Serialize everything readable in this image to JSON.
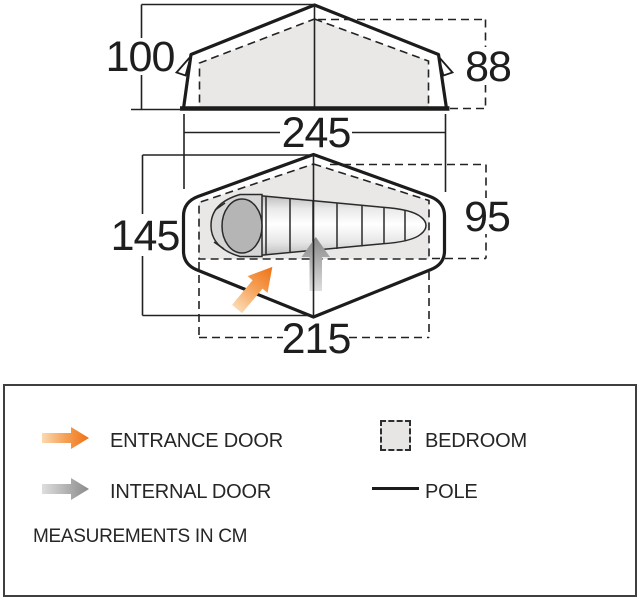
{
  "side_view": {
    "peak_height": "100",
    "inner_height": "88",
    "base_width": "245"
  },
  "plan_view": {
    "outer_width": "145",
    "bedroom_width": "95",
    "bedroom_length": "215"
  },
  "legend": {
    "entrance_door_label": "ENTRANCE DOOR",
    "internal_door_label": "INTERNAL DOOR",
    "bedroom_label": "BEDROOM",
    "pole_label": "POLE",
    "note": "MEASUREMENTS IN CM"
  },
  "colors": {
    "entrance_arrow": "#ef7115",
    "internal_arrow": "#8a8a8a",
    "bedroom_fill": "#e9e8e6",
    "outline": "#1c1c1c"
  }
}
